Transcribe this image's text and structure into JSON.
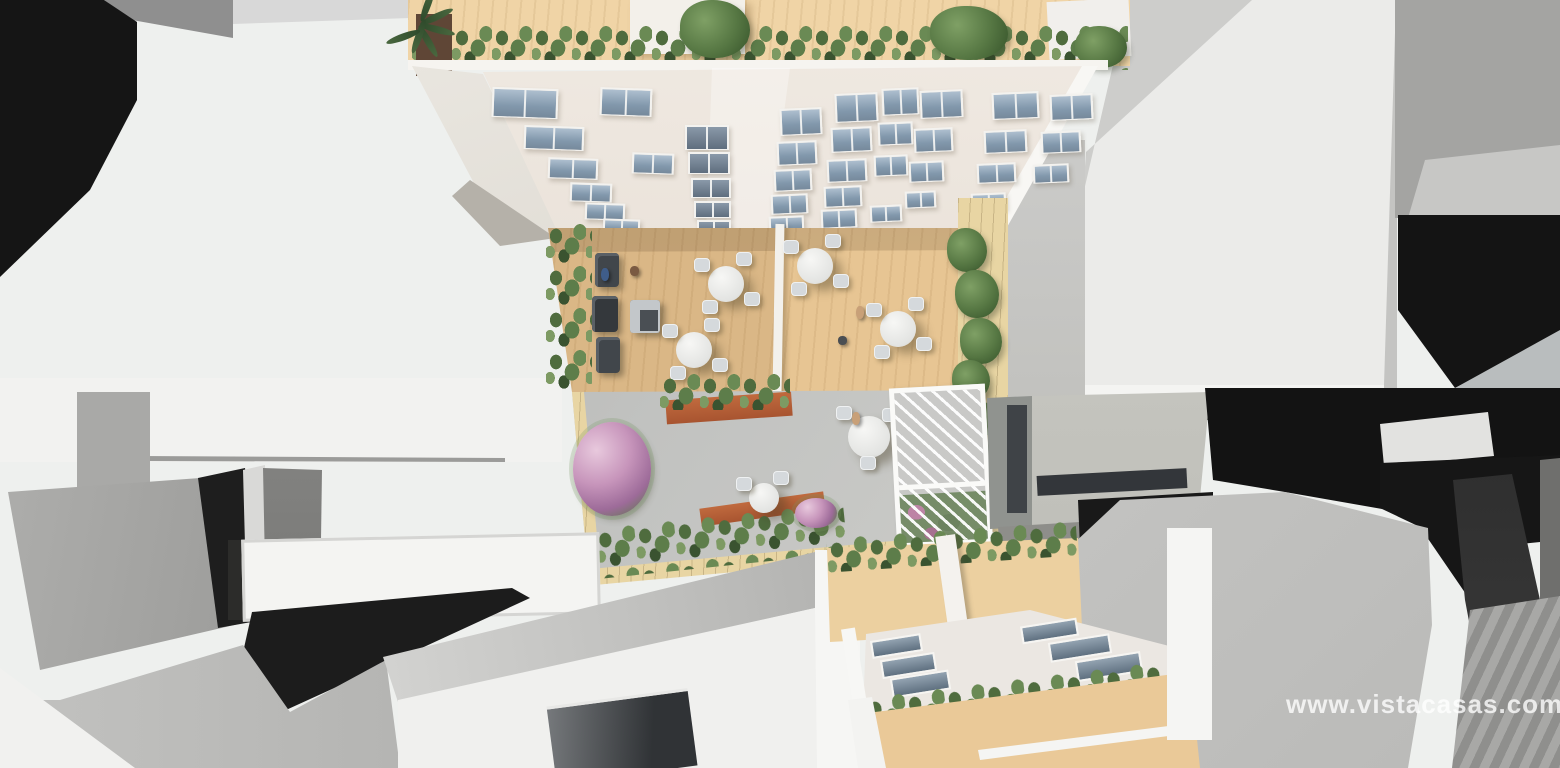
{
  "watermark": {
    "text": "www.vistacasas.com"
  },
  "palette": {
    "roof_terrace_tan": "#f0d4a6",
    "terrace_deck_wood": "#e7c593",
    "facade_white": "#ece5dd",
    "window_glass": "#8ca0b4",
    "hedge_green": "#55744a",
    "flower_pink": "#c795bb",
    "corten_planter": "#ab5a34",
    "courtyard_concrete": "#c3c3c1",
    "stone_border": "#e6d2a0",
    "pergola_white": "#fafaf8",
    "massing_white": "#f2f2f0",
    "massing_gray": "#a4a4a2",
    "shadow_black": "#141414"
  }
}
